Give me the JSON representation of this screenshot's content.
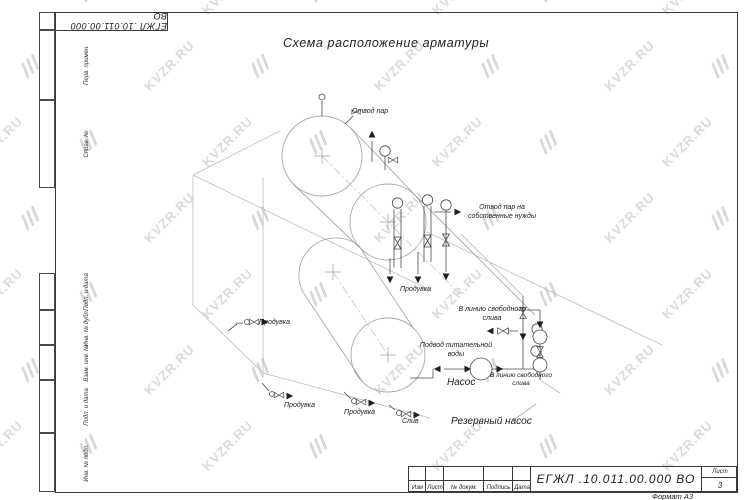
{
  "watermark": {
    "text": "KVZR.RU",
    "color": "#d7dbde"
  },
  "sheet": {
    "title": "Схема расположение арматуры",
    "top_stamp": "ЕГЖЛ .10.011.00.000  ВО",
    "format_note": "Формат А3"
  },
  "margin_labels": {
    "perv": "Перв. примен.",
    "sprav": "Справ. №",
    "podp1": "Подп. и дата",
    "inv_dubl": "Инв. № дубл.",
    "vzam": "Взам. инв. №",
    "podp2": "Подп. и дата",
    "inv_podl": "Инв. № подл."
  },
  "annotations": {
    "otvod_par": "Отвод пар",
    "otvod_par_nuzhdy": "Отвод пар на собственные нужды",
    "produvka_top": "Продувка",
    "produvka_left": "Продувка",
    "v_liniyu_sliva_1": "В линию свободного слива",
    "podvod_vody": "Подвод питательной воды",
    "nasos": "Насос",
    "v_liniyu_sliva_2": "В линию свободного слива",
    "produvka_1": "Продувка",
    "produvka_2": "Продувка",
    "sliv": "Слив",
    "rezervny_nasos": "Резервный насос"
  },
  "title_block": {
    "izm": "Изм",
    "list": "Лист",
    "doc": "№ докум.",
    "podpis": "Подпись",
    "data": "Дата",
    "designation": "ЕГЖЛ .10.011.00.000  ВО",
    "sheet_label": "Лист",
    "sheet_number": "3"
  }
}
